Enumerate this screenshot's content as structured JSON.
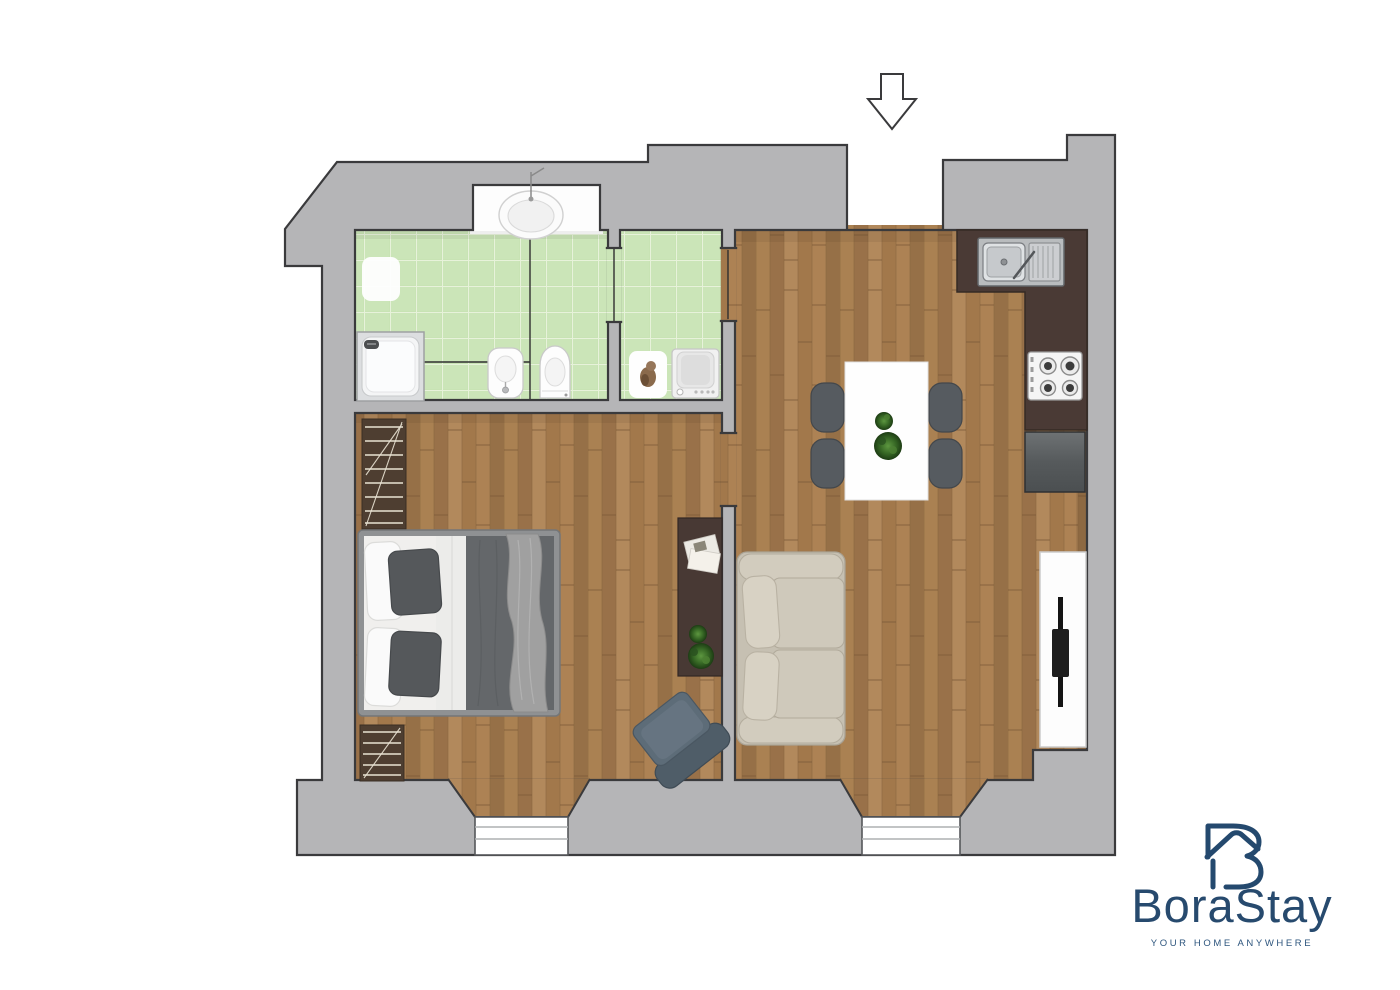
{
  "logo": {
    "name": "BoraStay",
    "tagline": "YOUR HOME ANYWHERE",
    "icon": "house-b-monogram-icon",
    "color": "#274a6e"
  },
  "annotations": {
    "entrance_arrow": "down-arrow-icon"
  },
  "colors": {
    "wall_fill": "#b5b5b7",
    "wall_outline": "#3a3a3c",
    "wood_floor": "#a67c4e",
    "bathroom_tile": "#c8e3b4",
    "kitchen_counter": "#4a3a35",
    "sofa": "#cfc9bb",
    "dining_chair": "#565b60",
    "appliance_gray": "#5d6163",
    "logo_navy": "#274a6e"
  },
  "floorplan": {
    "rooms": [
      {
        "name": "bathroom",
        "floor": "green-tile",
        "fixtures": [
          "wash-basin",
          "bath-mat",
          "shower-tray",
          "bidet",
          "toilet"
        ]
      },
      {
        "name": "laundry-room",
        "floor": "green-tile",
        "fixtures": [
          "pet-mat",
          "washing-machine"
        ]
      },
      {
        "name": "bedroom",
        "floor": "wood",
        "fixtures": [
          "double-bed",
          "radiator",
          "radiator",
          "sideboard",
          "magazines",
          "potted-plant",
          "armchair",
          "window"
        ]
      },
      {
        "name": "living-kitchen",
        "floor": "wood",
        "fixtures": [
          "kitchen-counter",
          "kitchen-sink",
          "gas-hob",
          "under-counter-appliance",
          "dining-table",
          "dining-chair",
          "dining-chair",
          "dining-chair",
          "dining-chair",
          "table-plant",
          "sofa",
          "tv-console",
          "tv",
          "window",
          "entrance-opening"
        ]
      }
    ]
  }
}
